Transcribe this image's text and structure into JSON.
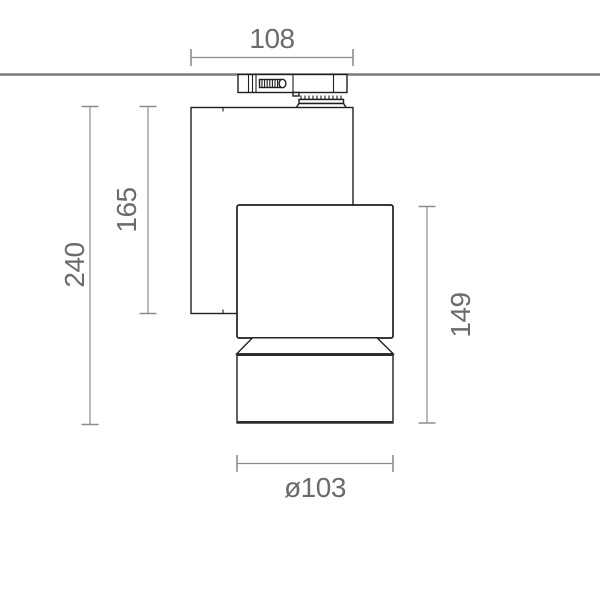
{
  "colors": {
    "background": "#ffffff",
    "fixture_outline": "#1f1f1f",
    "heavy_edge": "#2b2b2b",
    "ceiling_line": "#7a7a7a",
    "dimension_line": "#8d8d8d",
    "dimension_text": "#6b6b6b"
  },
  "dimensions": {
    "adapter_width": {
      "label": "108"
    },
    "overall_height": {
      "label": "240"
    },
    "body_height": {
      "label": "165"
    },
    "head_height": {
      "label": "149"
    },
    "head_diameter": {
      "label": "ø103"
    }
  },
  "parts": {
    "ceiling_line": "ceiling-track-line",
    "track_adapter": "track-adapter",
    "lamp_body": "housing",
    "lamp_head": "spot-head",
    "lamp_bezel": "bezel-cone",
    "lamp_cylinder": "shade-cylinder"
  }
}
